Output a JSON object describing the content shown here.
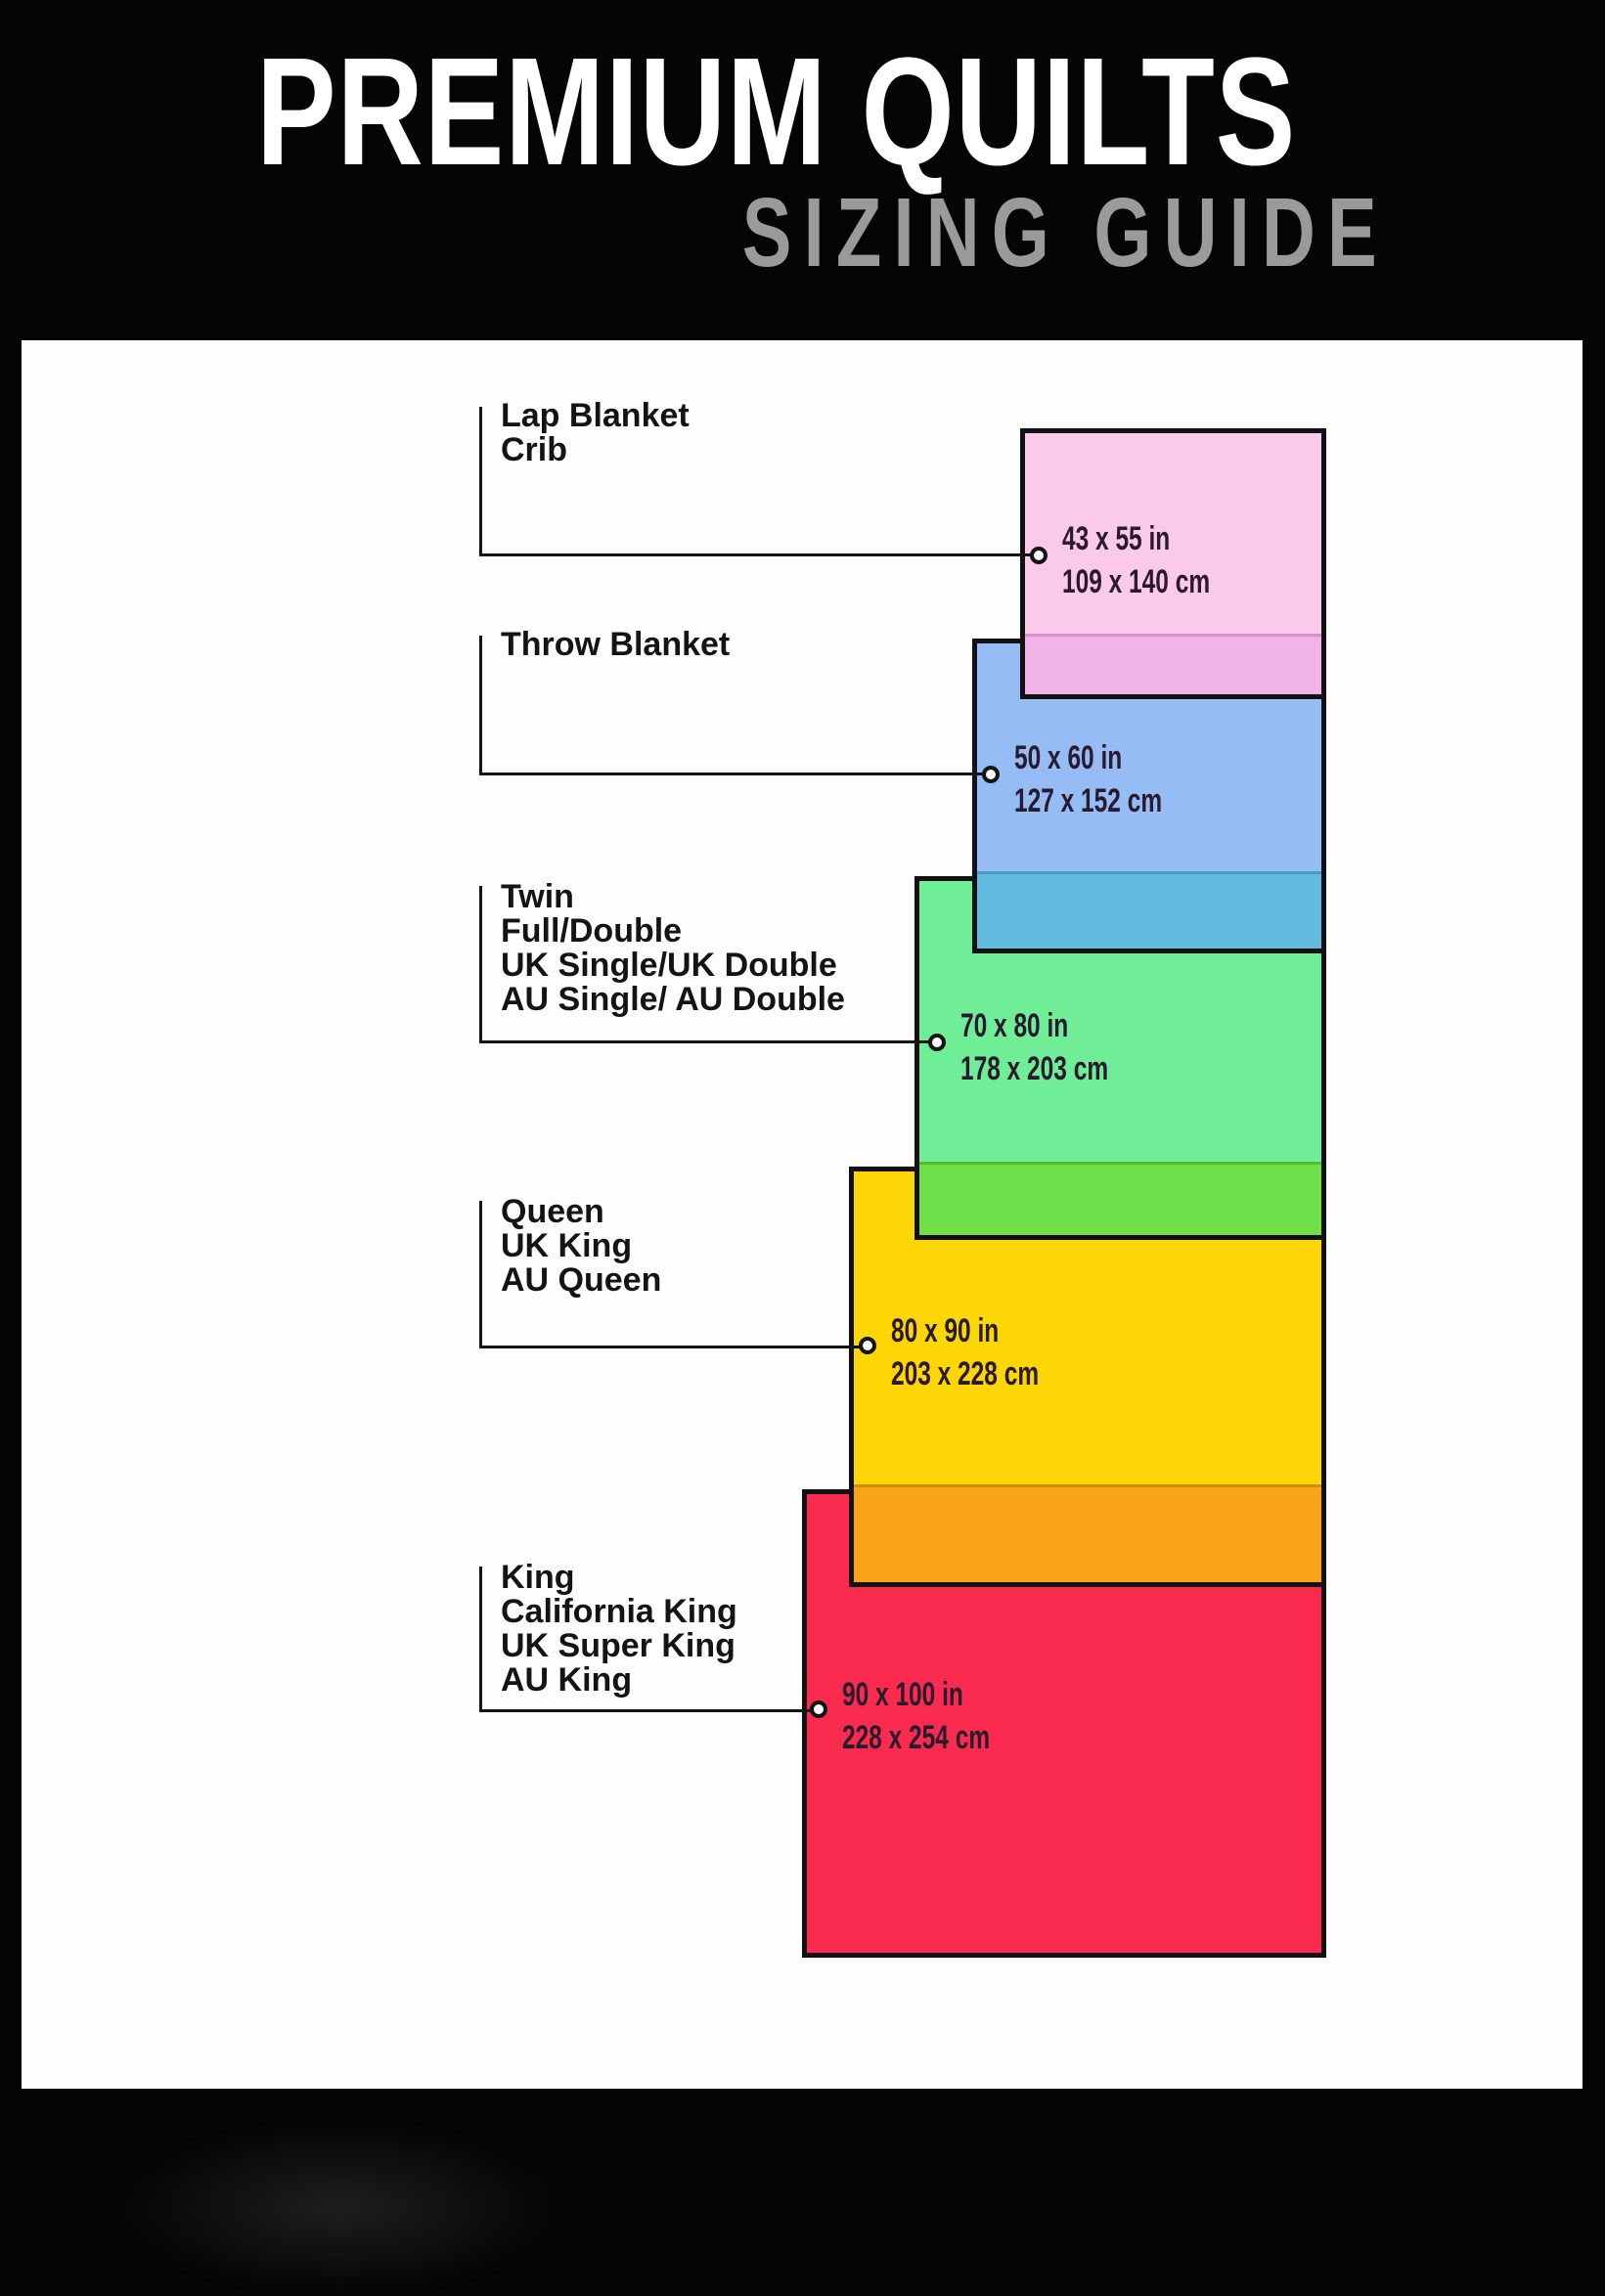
{
  "header": {
    "title": "PREMIUM QUILTS",
    "subtitle": "SIZING GUIDE",
    "title_color": "#ffffff",
    "subtitle_color": "#9a9a9a",
    "background": "#050505"
  },
  "panel_background": "#fdfdfd",
  "line_color": "#141414",
  "sizes": [
    {
      "labels": [
        "Lap Blanket",
        "Crib"
      ],
      "inches": "43 x 55 in",
      "cm": "109 x 140 cm",
      "color": "#fbc9e9",
      "overlap_color": "#f1b2e5",
      "overlap_line": "#d88fcb"
    },
    {
      "labels": [
        "Throw Blanket"
      ],
      "inches": "50 x 60 in",
      "cm": "127 x 152 cm",
      "color": "#95bcf5",
      "overlap_color": "#62badf",
      "overlap_line": "#4a9ac4"
    },
    {
      "labels": [
        "Twin",
        "Full/Double",
        "UK Single/UK Double",
        "AU Single/ AU Double"
      ],
      "inches": "70 x 80 in",
      "cm": "178 x 203 cm",
      "color": "#6fee97",
      "overlap_color": "#70e04a",
      "overlap_line": "#54bd2f"
    },
    {
      "labels": [
        "Queen",
        "UK King",
        "AU Queen"
      ],
      "inches": "80 x 90 in",
      "cm": "203 x 228 cm",
      "color": "#fdd605",
      "overlap_color": "#f9a517",
      "overlap_line": "#d28a10"
    },
    {
      "labels": [
        "King",
        "California King",
        "UK Super King",
        "AU King"
      ],
      "inches": "90 x 100 in",
      "cm": "228 x 254 cm",
      "color": "#fb2b4f",
      "overlap_color": null,
      "overlap_line": null
    }
  ]
}
